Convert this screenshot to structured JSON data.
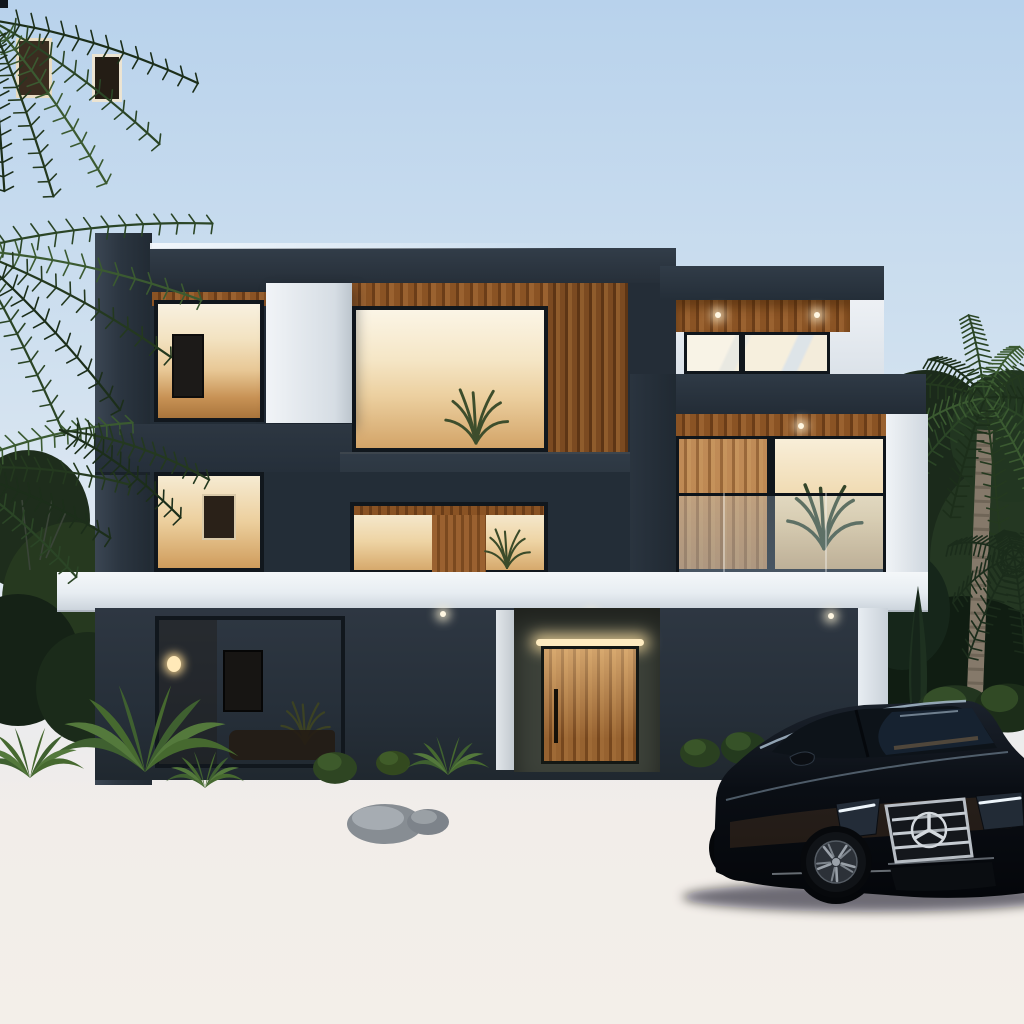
{
  "scene": {
    "kind": "photorealistic architectural rendering",
    "subject": "modern three-storey villa at dusk with warm interior lighting, front lawn, illuminated entry steps, black luxury sedan on the driveway and palm trees",
    "no_visible_text": true
  },
  "palette": {
    "skyTop": "#b8d2ec",
    "skyMid": "#cfe0ef",
    "skyHorizon": "#f2ede9",
    "facadeDark": "#2b3540",
    "facadeWhite": "#e8edf2",
    "woodSlat": "#8a5526",
    "doorWood": "#b5793e",
    "interiorGlow": "#f3e3c2",
    "interiorAmber": "#e8c896",
    "lawnGreen": "#47682a",
    "treeDark": "#1e2d1c",
    "palmGreen": "#2b4526",
    "sidewalkGray": "#c2c6cb",
    "roadGray": "#4c525b",
    "stepWhite": "#f2f3f5",
    "stepGlow": "#fff8e8",
    "carBlack": "#070a0f",
    "chrome": "#c6ccd3",
    "headlightDRL": "#eef6fc",
    "wallGray": "#585e64",
    "rockGray": "#9aa0a5"
  },
  "objects": {
    "building": {
      "storeys": 3,
      "style": "flat-roof modern",
      "materials": [
        "charcoal render",
        "white render",
        "timber slats",
        "glass"
      ]
    },
    "entry": {
      "door": "vertical timber slat pivot door",
      "steps_lit": 6
    },
    "vehicle": {
      "type": "luxury sedan",
      "color": "black",
      "grille_emblem": "three-pointed-star"
    },
    "vegetation": [
      "palm-left",
      "palm-right",
      "cypress",
      "agave",
      "round-bushes",
      "background-trees"
    ],
    "lighting": [
      "warm interior glow",
      "soffit downlights",
      "LED step strips",
      "door halo light"
    ]
  }
}
